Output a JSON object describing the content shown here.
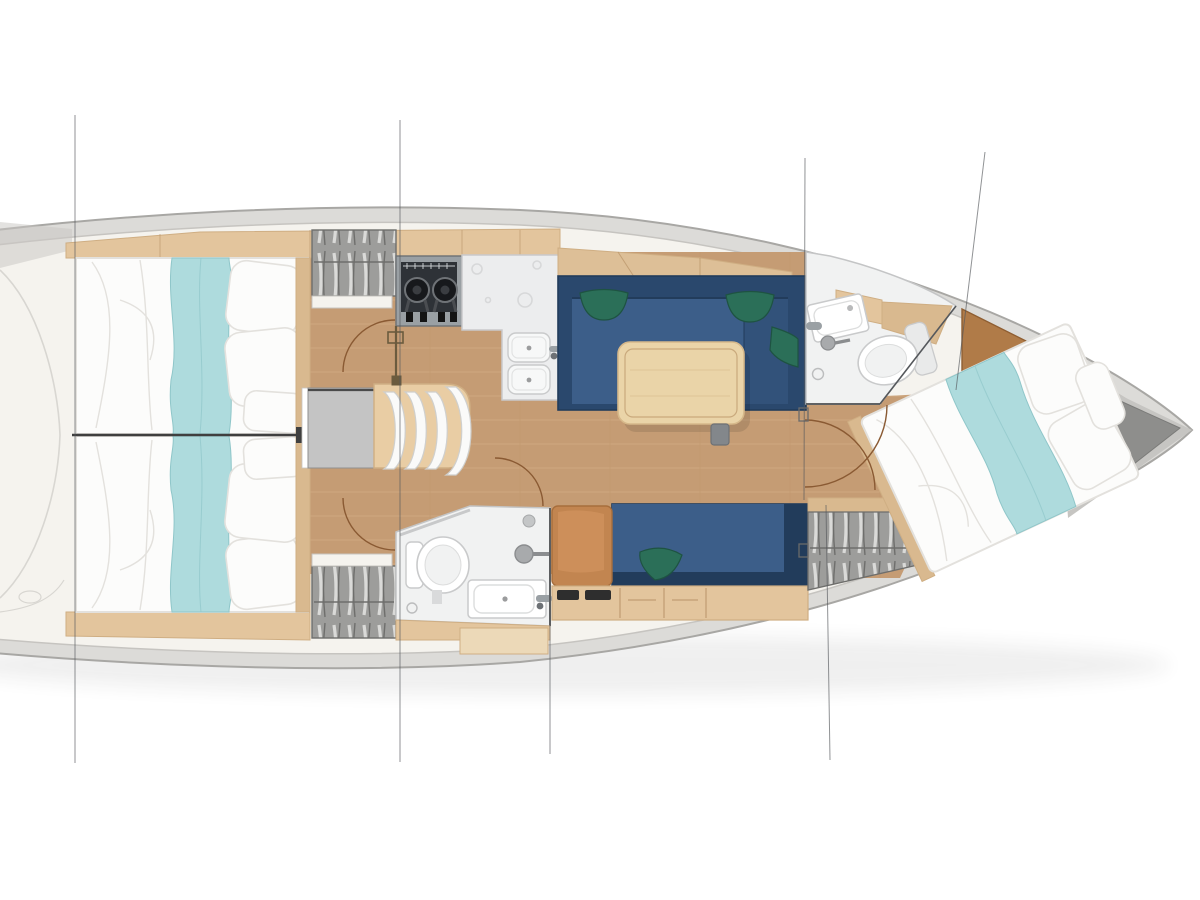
{
  "title": "",
  "visible_text": [],
  "diagram": {
    "kind": "sailboat-interior-deck-plan",
    "orientation": "bow-right",
    "rooms": [
      {
        "id": "aft-cabin-port",
        "contents": [
          "double-bed",
          "wardrobe"
        ]
      },
      {
        "id": "aft-cabin-starboard",
        "contents": [
          "double-bed",
          "wardrobe"
        ]
      },
      {
        "id": "galley",
        "contents": [
          "two-burner-stove",
          "counter",
          "double-sink"
        ]
      },
      {
        "id": "companionway",
        "contents": [
          "stairs-3-steps",
          "chart-table"
        ]
      },
      {
        "id": "saloon",
        "contents": [
          "u-settee-navy",
          "dining-table",
          "bench-navy",
          "green-cushions"
        ]
      },
      {
        "id": "aft-head",
        "contents": [
          "toilet",
          "sink",
          "shower"
        ]
      },
      {
        "id": "forward-head",
        "contents": [
          "toilet",
          "sink",
          "shower"
        ]
      },
      {
        "id": "forward-cabin",
        "contents": [
          "v-berth-double-bed",
          "wardrobe",
          "bow-locker"
        ]
      }
    ],
    "section_line_count": 6,
    "door_arc_count": 5
  },
  "colors": {
    "page_bg": "#ffffff",
    "shadow": "#2b2b2b",
    "hull_band": "#dcdbd8",
    "hull_edge": "#a8a7a4",
    "deck": "#f5f3ee",
    "deck_line": "#c6c4c0",
    "ghost": "#c9c7c3",
    "floor": "#c59c74",
    "floor_plank": "#d8b28a",
    "wood": "#e3c59d",
    "wood_dark": "#cfae83",
    "wood_seam": "#b99469",
    "wood_trim": "#d9b98f",
    "locker": "#ddbf97",
    "bulkhead": "#b07b48",
    "bulkhead_edge": "#8f5f33",
    "navy": "#2a486d",
    "navy_seat": "#3c5e89",
    "navy_dark": "#223c5b",
    "green": "#2b6f58",
    "green_dark": "#1e5342",
    "aqua": "#aedbdd",
    "aqua_line": "#8fc6c9",
    "bed_white": "#fcfcfb",
    "bed_line": "#e3e1dd",
    "gray_unit": "#c4c4c4",
    "gray_unit_edge": "#8f8f8f",
    "hatch_bg": "#9d9d9b",
    "hatch_light": "#dadad8",
    "hatch_dark": "#6e6e6c",
    "fixture": "#f1f2f2",
    "fixture_line": "#c9cacb",
    "fixture_shade": "#e4e5e6",
    "steel": "#9aa0a4",
    "steel_dark": "#6d7175",
    "stove": "#2e3237",
    "burner": "#17191c",
    "arc": "#8a5a33",
    "post": "#6b5b3e",
    "section": "#55585c",
    "divider": "#3f3f3f"
  }
}
